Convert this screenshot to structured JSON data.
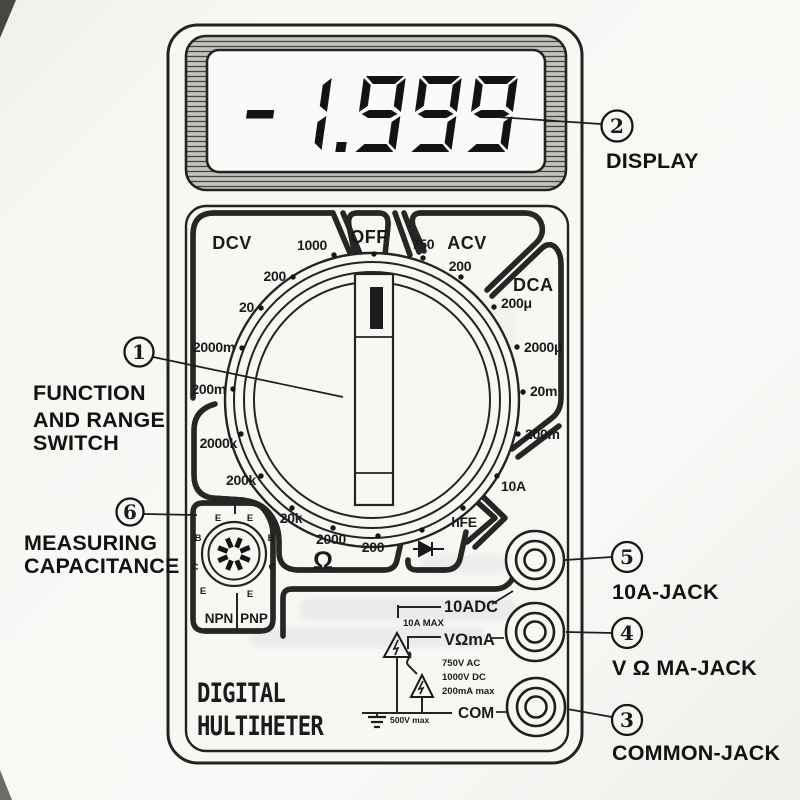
{
  "display": {
    "value": "-1.999"
  },
  "brand": {
    "line1": "DIGITAL",
    "line2": "HULTIHETER"
  },
  "dial": {
    "dcv_label": "DCV",
    "off_label": "OFF",
    "acv_label": "ACV",
    "dca_label": "DCA",
    "dcv_ranges": [
      "1000",
      "200",
      "20",
      "2000m",
      "200m"
    ],
    "acv_ranges": [
      "750",
      "200"
    ],
    "dca_ranges": [
      "200μ",
      "2000μ",
      "20m",
      "200m"
    ],
    "ohm_ranges": [
      "2000k",
      "200k",
      "20k",
      "2000",
      "200"
    ],
    "ohm_symbol": "Ω",
    "ten_amp": "10A",
    "hfe": "hFE"
  },
  "socket": {
    "npn": "NPN",
    "pnp": "PNP",
    "pins_top": [
      "E",
      "E"
    ],
    "pins_mid": [
      "B",
      "B"
    ],
    "pins_low": [
      "C",
      "C"
    ],
    "pins_bottom": [
      "E",
      "E"
    ]
  },
  "jack_panel": {
    "ten_adc": "10ADC",
    "ten_a_max": "10A MAX",
    "v_ohm_ma": "VΩmA",
    "ratings": [
      "750V AC",
      "1000V DC",
      "200mA  max"
    ],
    "com": "COM",
    "ground_max": "500V  max"
  },
  "callouts": {
    "c1": {
      "num": "1",
      "lines": [
        "FUNCTION",
        "AND RANGE",
        "SWITCH"
      ]
    },
    "c2": {
      "num": "2",
      "lines": [
        "DISPLAY"
      ]
    },
    "c3": {
      "num": "3",
      "lines": [
        "COMMON-JACK"
      ]
    },
    "c4": {
      "num": "4",
      "lines": [
        "V Ω MA-JACK"
      ]
    },
    "c5": {
      "num": "5",
      "lines": [
        "10A-JACK"
      ]
    },
    "c6": {
      "num": "6",
      "lines": [
        "MEASURING",
        "CAPACITANCE"
      ]
    }
  }
}
